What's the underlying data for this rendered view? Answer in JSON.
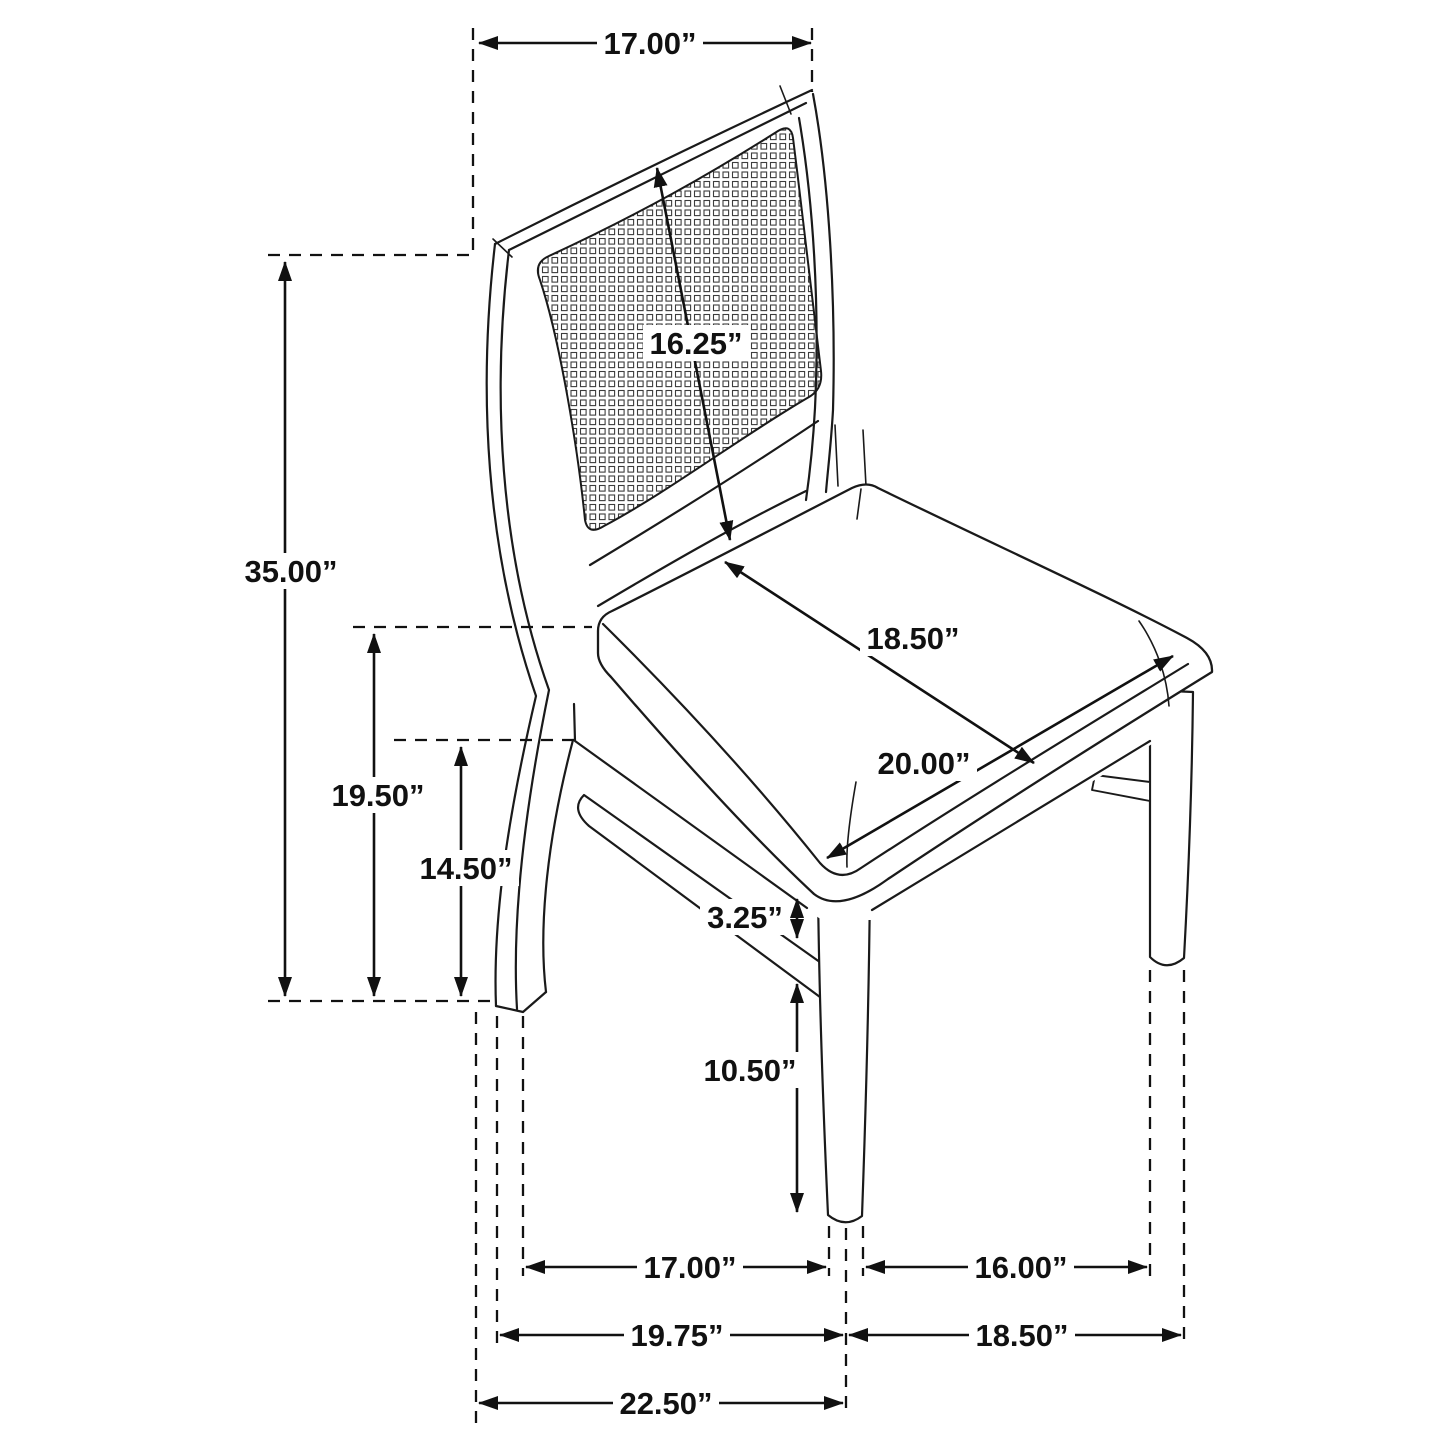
{
  "figure": {
    "type": "furniture-dimension-diagram",
    "subject": "dining side chair with cane back, isometric line drawing",
    "background_color": "#ffffff",
    "line_color": "#111111"
  },
  "dimensions": {
    "top_back_width": "17.00”",
    "overall_height": "35.00”",
    "back_panel_height": "16.25”",
    "seat_depth": "18.50”",
    "seat_width": "20.00”",
    "seat_height": "19.50”",
    "apron_floor_height": "14.50”",
    "stretcher_gap": "3.25”",
    "front_leg_clearance": "10.50”",
    "feet_inner_span": "17.00”",
    "feet_right_span": "16.00”",
    "base_depth_left": "19.75”",
    "base_width_right": "18.50”",
    "overall_depth": "22.50”"
  }
}
